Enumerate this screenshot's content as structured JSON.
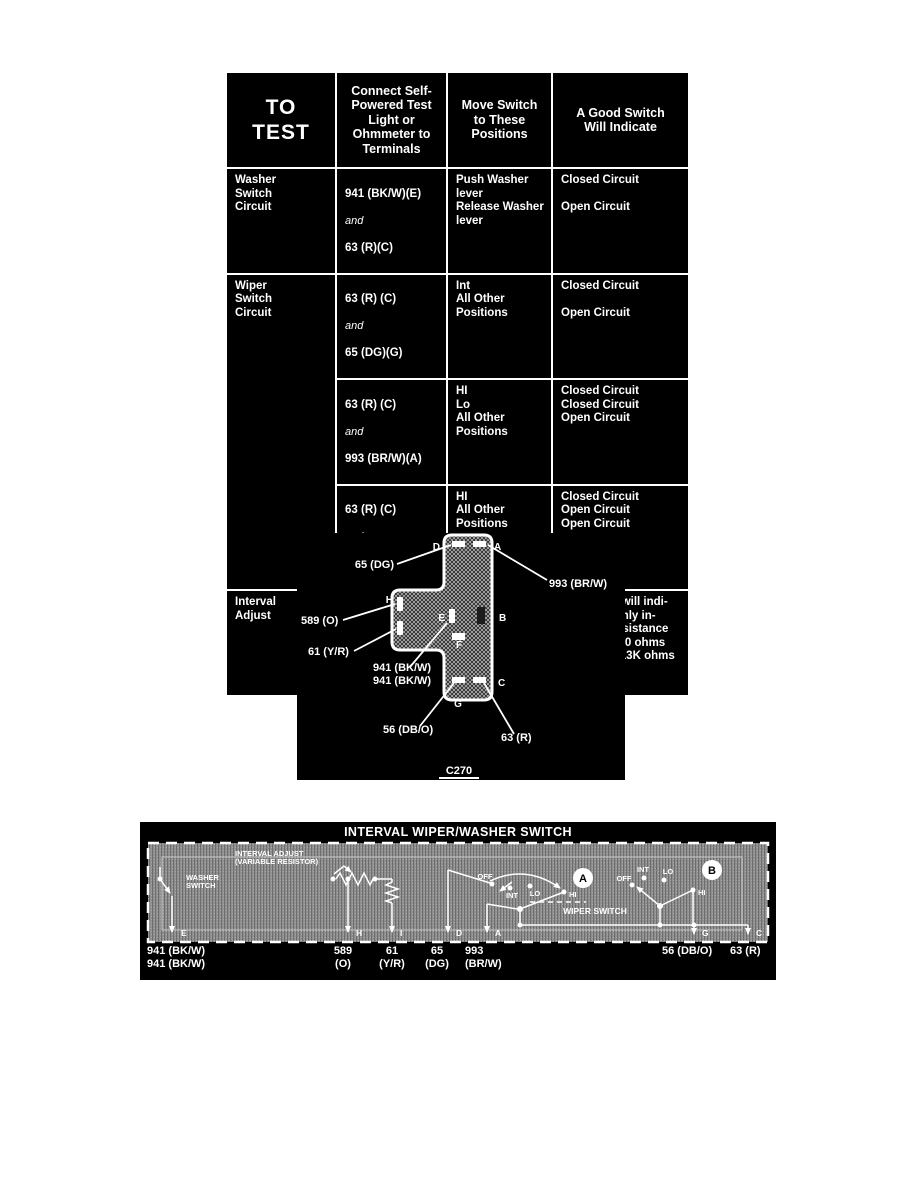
{
  "test_table": {
    "headers": [
      "TO\nTEST",
      "Connect Self-\nPowered Test\nLight or\nOhmmeter to\nTerminals",
      "Move Switch\nto These\nPositions",
      "A Good Switch\nWill Indicate"
    ],
    "rows": [
      {
        "circuit": "Washer\nSwitch\nCircuit",
        "terminal_top": "941 (BK/W)(E)",
        "conjunction": "and",
        "terminal_bottom": "63 (R)(C)",
        "positions": "Push Washer\nlever\nRelease Washer\nlever",
        "result": "Closed Circuit\n\nOpen Circuit"
      },
      {
        "circuit": "Wiper\nSwitch\nCircuit",
        "terminal_top": "63 (R) (C)",
        "conjunction": "and",
        "terminal_bottom": "65 (DG)(G)",
        "positions": "Int\nAll Other\nPositions",
        "result": "Closed Circuit\n\nOpen Circuit"
      },
      {
        "terminal_top": "63 (R) (C)",
        "conjunction": "and",
        "terminal_bottom": "993 (BR/W)(A)",
        "positions": "HI\nLo\nAll Other Positions",
        "result": "Closed Circuit\nClosed Circuit\nOpen Circuit"
      },
      {
        "terminal_top": "63 (R) (C)",
        "conjunction": "and",
        "terminal_bottom": "56 (DB/O)(G)",
        "positions": "HI\nAll Other\nPositions",
        "result": "Closed Circuit\nOpen Circuit\nOpen Circuit"
      },
      {
        "circuit": "Interval\nAdjust",
        "terminal_top": "589 (O)(H)",
        "conjunction": "and",
        "terminal_bottom": "61 (Y/R) (I)",
        "positions": "Rotate Control\nClockwise",
        "result": "Ohmmeter will indi-\ncate smoothly in-\ncreasing resistance\nfrom 420/880 ohms\nmin. to 7K/13K ohms\nmax."
      }
    ]
  },
  "connector": {
    "code": "C270",
    "terminals": [
      "D",
      "A",
      "H",
      "I",
      "E",
      "B",
      "F",
      "G",
      "C"
    ],
    "labels": {
      "dg": "65 (DG)",
      "brw": "993 (BR/W)",
      "o": "589 (O)",
      "yr": "61 (Y/R)",
      "bkw_1": "941 (BK/W)",
      "bkw_2": "941 (BK/W)",
      "dbo": "56 (DB/O)",
      "r": "63 (R)"
    }
  },
  "schematic": {
    "title": "INTERVAL WIPER/WASHER SWITCH",
    "washer_switch_label": [
      "WASHER",
      "SWITCH"
    ],
    "interval_adjust_label": [
      "INTERVAL ADJUST",
      "(VARIABLE RESISTOR)"
    ],
    "wiper_switch_label": "WIPER SWITCH",
    "rotary_a": {
      "positions": [
        "OFF",
        "INT",
        "LO",
        "HI"
      ],
      "knob": "A"
    },
    "rotary_b": {
      "positions": [
        "OFF",
        "INT",
        "LO",
        "HI"
      ],
      "knob": "B"
    },
    "terminals": [
      "E",
      "H",
      "I",
      "D",
      "A",
      "G",
      "C"
    ],
    "wire_labels": {
      "e": [
        "941 (BK/W)",
        "941 (BK/W)"
      ],
      "h": [
        "589",
        "(O)"
      ],
      "i": [
        "61",
        "(Y/R)"
      ],
      "d": [
        "65",
        "(DG)"
      ],
      "a": [
        "993",
        "(BR/W)"
      ],
      "g": "56 (DB/O)",
      "c": "63 (R)"
    },
    "colors": {
      "panel": "#000000",
      "texture": "#8f8f8f",
      "ink": "#ffffff"
    }
  }
}
